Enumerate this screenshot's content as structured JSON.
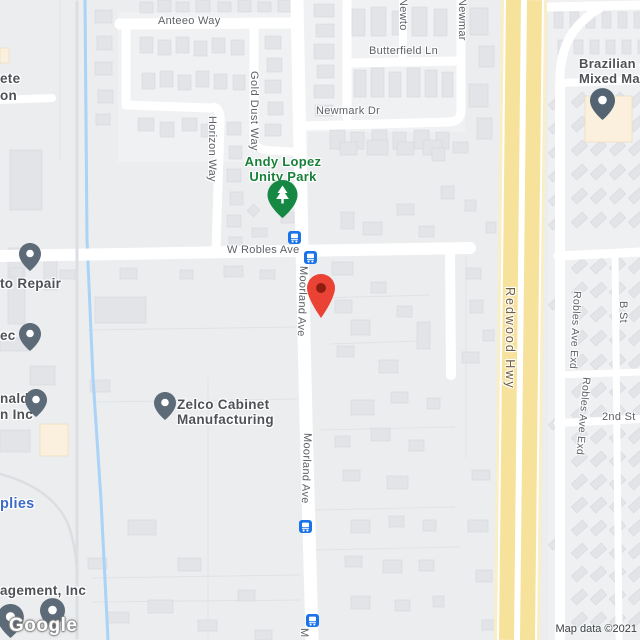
{
  "map": {
    "streets": {
      "anteeo": "Anteeo Way",
      "butterfield": "Butterfield Ln",
      "newmark_dr": "Newmark Dr",
      "newton_cut": "Newto",
      "newmark_cut": "Newmar",
      "gold_dust": "Gold Dust Way",
      "horizon": "Horizon Way",
      "w_robles": "W Robles Ave",
      "moorland_1": "Moorland Ave",
      "moorland_2": "Moorland Ave",
      "moorland_cut": "M",
      "redwood": "Redwood Hwy",
      "robles_exd_1": "Robles Ave Exd",
      "robles_exd_2": "Robles Ave Exd",
      "b_st": "B St",
      "second_st": "2nd St"
    },
    "pois": {
      "park_1": "Andy Lopez",
      "park_2": "Unity Park",
      "zelco_1": "Zelco Cabinet",
      "zelco_2": "Manufacturing",
      "brazil_1": "Brazilian A",
      "brazil_2": "Mixed Ma",
      "repair_cut": "to Repair",
      "ec_cut": "ec",
      "ete_cut": "ete",
      "on_cut": "on",
      "nald_cut": "nald",
      "inc_cut": "n Inc",
      "supplies_cut": "plies",
      "management_cut": "agement, Inc"
    },
    "icons": {
      "location_marker": "red-location-pin",
      "bus_stop": "bus-in-blue-square",
      "park_pin": "tree-in-green-pin",
      "business_pin": "dot-in-slate-pin"
    },
    "colors": {
      "marker_red": "#ea4335",
      "marker_inner": "#8f1d10",
      "transit_blue": "#1a73e8",
      "pin_slate": "#5d6b78",
      "park_green": "#158843",
      "park_label_green": "#188038",
      "highway_yellow": "#f7e29b",
      "water_blue": "#a9d3f7",
      "road_white": "#ffffff",
      "street_label_gray": "#5d6167",
      "poi_label_gray": "#4e5257",
      "poi_link_blue": "#3e6bc9",
      "highway_label_brown": "#6f5f3f"
    },
    "footer": {
      "logo": "Google",
      "attribution": "Map data ©2021"
    }
  }
}
